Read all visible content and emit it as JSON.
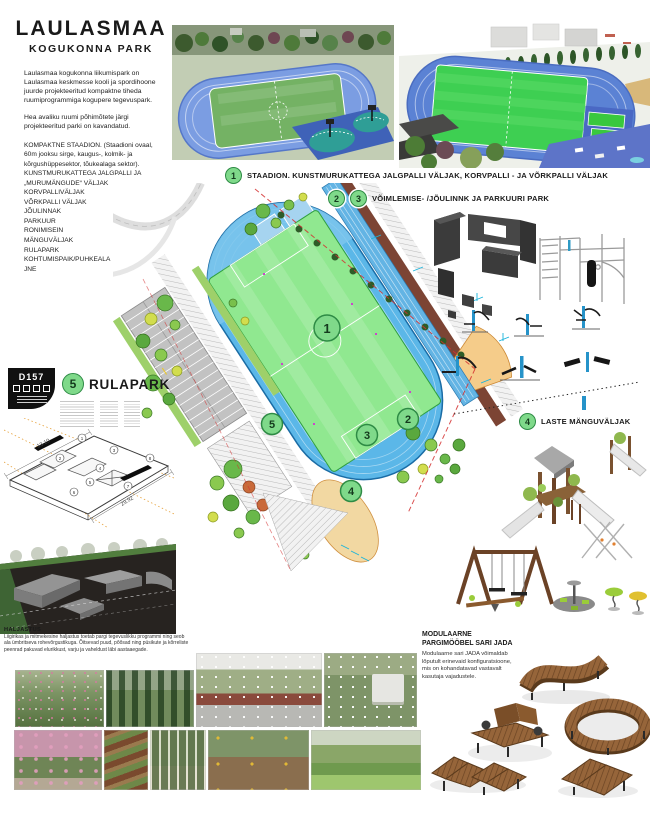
{
  "header": {
    "title_line1": "LAULASMAA",
    "title_line2": "KOGUKONNA PARK",
    "intro_p1": "Laulasmaa kogukonna liikumispark on Laulasmaa keskmesse kooli ja spordihoone juurde projekteeritud kompaktne tiheda ruumiprogrammiga kogupere tegevuspark.",
    "intro_p2": "Hea avaliku ruumi põhimõtete järgi projekteeritud parki on kavandatud.",
    "features": [
      "KOMPAKTNE STAADION. (Staadioni ovaal, 60m jooksu sirge, kaugus-, kolmik- ja kõrgushüppesektor, tõukealaga sektor).",
      "KUNSTMURUKATTEGA JALGPALLI JA „MURUMÄNGUDE“ VÄLJAK",
      "KORVPALLIVÄLJAK",
      "VÕRKPALLI VÄLJAK",
      "JÕULINNAK",
      "PARKUUR",
      "RONIMISEIN",
      "MÄNGUVÄLJAK",
      "RULAPARK",
      "KOHTUMISPAIK/PUHKEALA",
      "JNE"
    ]
  },
  "legend": {
    "item1": {
      "num": "1",
      "label": "STAADION. KUNSTMURUKATTEGA JALGPALLI VÄLJAK, KORVPALLI - JA VÕRKPALLI VÄLJAK"
    },
    "item23": {
      "num_a": "2",
      "num_b": "3",
      "label": "VÕIMLEMISE- /JÕULINNK JA PARKUURI PARK"
    },
    "item4": {
      "num": "4",
      "label": "LASTE MÄNGUVÄLJAK"
    },
    "item5": {
      "num": "5",
      "label": "RULAPARK"
    }
  },
  "plan": {
    "markers": [
      "1",
      "2",
      "3",
      "4",
      "5"
    ]
  },
  "drawing": {
    "code": "D157",
    "dim_long": "29.92",
    "dim_short": "13.10",
    "parts": [
      "1",
      "2",
      "3",
      "4",
      "5",
      "6",
      "7",
      "8"
    ]
  },
  "landscape_note": {
    "heading": "HALJASTUS",
    "body": "Liigirikas ja mitmekesine haljastus toetab pargi tegevuslikku programmi ning seob ala ümbritseva rohevõrgustikuga. Õitsevad puud, põõsad ning püsikute ja kõrreliste peenrad pakuvad elurikkust, varju ja vaheldust läbi aastaaegade."
  },
  "furniture": {
    "heading_line1": "MODULAARNE",
    "heading_line2": "PARGIMÖÖBEL SARI JADA",
    "description": "Modulaarne sari JADA võimaldab lõputult erinevaid konfiguratsioone, mis on kohandatavad vastavalt kasutaja vajadustele."
  },
  "colors": {
    "badge_green": "#7fd98a",
    "track_blue": "#5bb7e8",
    "pitch_green": "#8fe68f",
    "sand": "#f2d8a2",
    "wood": "#96653a"
  }
}
